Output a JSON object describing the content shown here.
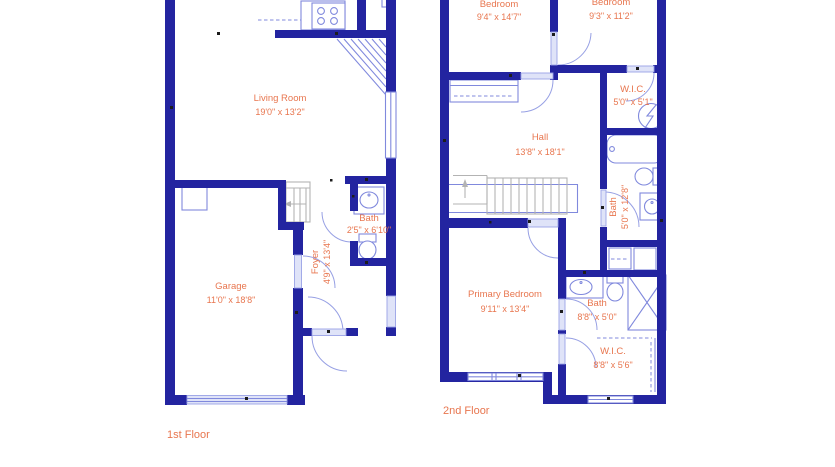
{
  "plan": {
    "background": "#ffffff",
    "colors": {
      "wall": "#2324a0",
      "fixture": "#8089dd",
      "stairs": "#b3b3b3",
      "label": "#e8764f"
    }
  },
  "floors": [
    {
      "title": "1st Floor",
      "rooms": {
        "living_room": {
          "name": "Living Room",
          "dims": "19'0\" x 13'2\""
        },
        "garage": {
          "name": "Garage",
          "dims": "11'0\" x 18'8\""
        },
        "bath": {
          "name": "Bath",
          "dims": "2'5\" x 6'10\""
        },
        "foyer": {
          "name": "Foyer",
          "dims": "4'9\" x 13'4\""
        }
      }
    },
    {
      "title": "2nd Floor",
      "rooms": {
        "bedroom_left": {
          "name": "Bedroom",
          "dims": "9'4\" x 14'7\""
        },
        "bedroom_right": {
          "name": "Bedroom",
          "dims": "9'3\" x 11'2\""
        },
        "wic_top": {
          "name": "W.I.C.",
          "dims": "5'0\" x 5'1\""
        },
        "hall": {
          "name": "Hall",
          "dims": "13'8\" x 18'1\""
        },
        "bath_long": {
          "name": "Bath",
          "dims": "5'0\" x 12'8\""
        },
        "primary_bedroom": {
          "name": "Primary Bedroom",
          "dims": "9'11\" x 13'4\""
        },
        "bath_lower": {
          "name": "Bath",
          "dims": "8'8\" x 5'0\""
        },
        "wic_lower": {
          "name": "W.I.C.",
          "dims": "8'8\" x 5'6\""
        }
      }
    }
  ]
}
